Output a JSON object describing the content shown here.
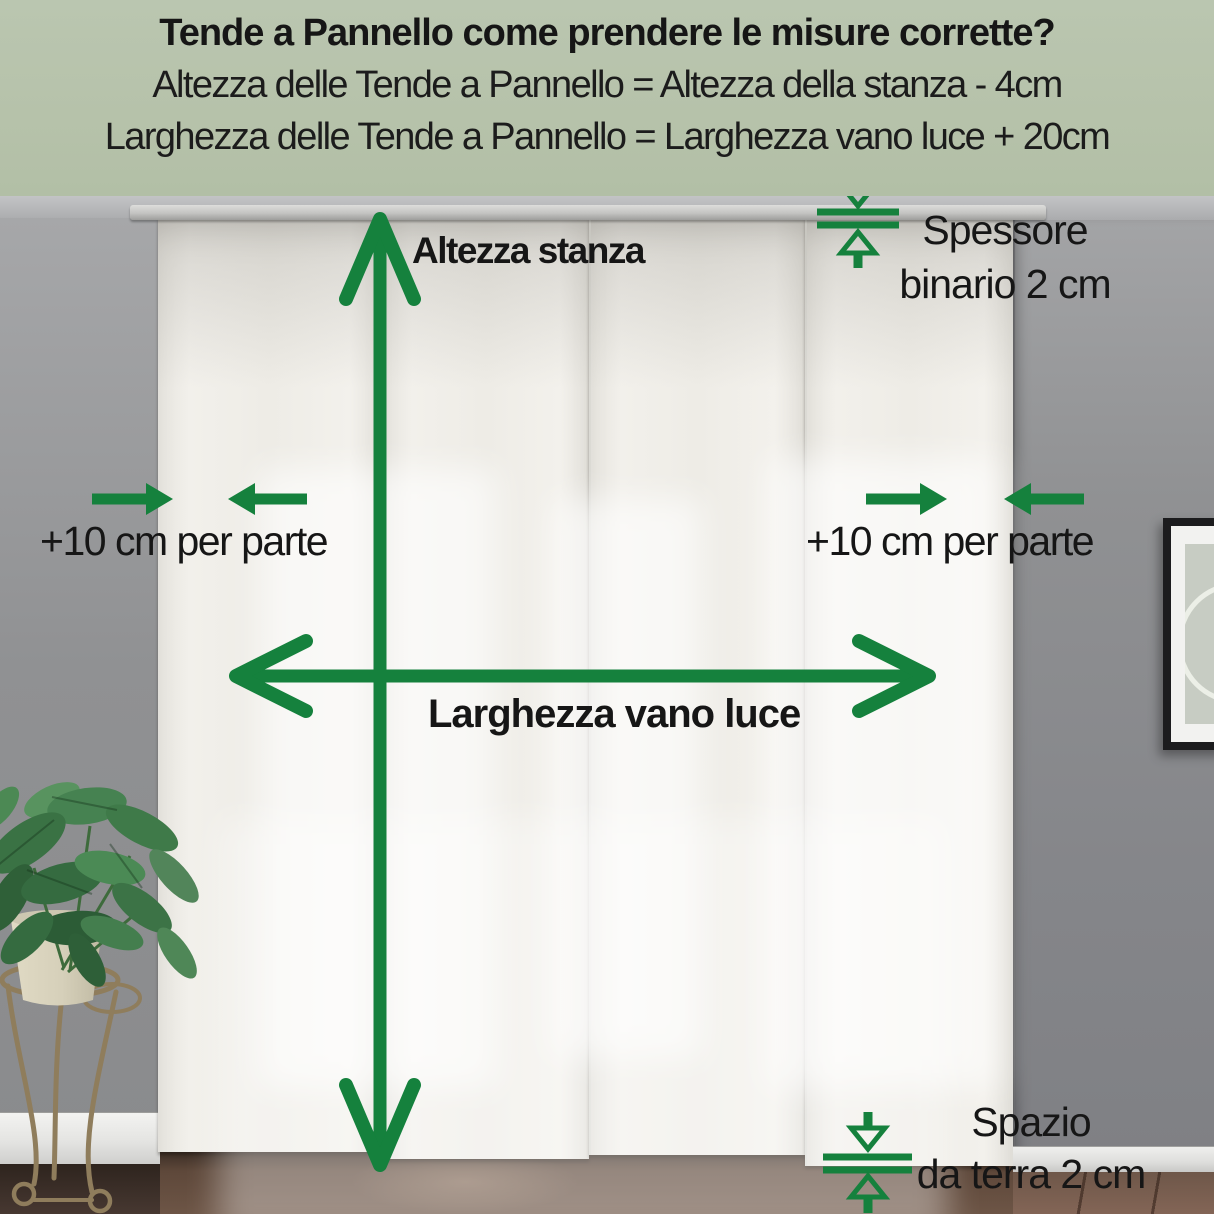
{
  "header": {
    "title": "Tende a Pannello come prendere le misure corrette?",
    "formula_height": "Altezza delle Tende a Pannello = Altezza della stanza - 4cm",
    "formula_width": "Larghezza delle Tende a Pannello = Larghezza vano luce + 20cm"
  },
  "labels": {
    "room_height": "Altezza stanza",
    "opening_width": "Larghezza vano luce",
    "side_allowance_left": "+10 cm per parte",
    "side_allowance_right": "+10 cm per parte",
    "track_thickness_line1": "Spessore",
    "track_thickness_line2": "binario 2 cm",
    "floor_gap_line1": "Spazio",
    "floor_gap_line2": "da terra 2 cm"
  },
  "colors": {
    "header_background": "#b6c2aa",
    "annotation_green": "#15813d",
    "text": "#1a1a1a",
    "curtain": "#efede7",
    "wall_gray": "#909193",
    "floor_brown": "#5e483a"
  }
}
